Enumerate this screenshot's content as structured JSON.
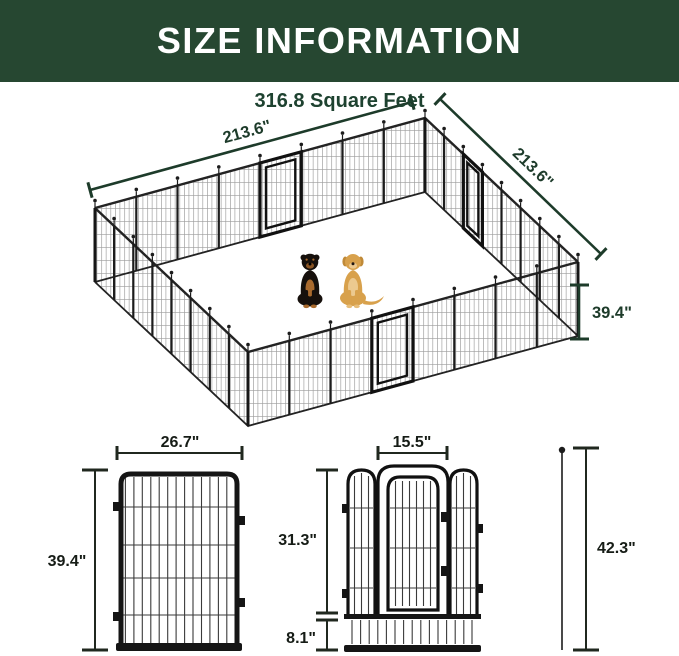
{
  "header": {
    "title": "SIZE INFORMATION"
  },
  "overview": {
    "area_label": "316.8 Square Feet",
    "width_label": "213.6\"",
    "depth_label": "213.6\"",
    "height_label": "39.4\"",
    "dogs": [
      "rottweiler",
      "golden-retriever"
    ]
  },
  "panel_detail": {
    "width_label": "26.7\"",
    "height_label": "39.4\""
  },
  "gate_detail": {
    "door_width_label": "15.5\"",
    "upper_height_label": "31.3\"",
    "bottom_height_label": "8.1\"",
    "total_height_label": "42.3\""
  },
  "colors": {
    "header_bg": "#264731",
    "accent_green": "#1d3b2a",
    "dim_dark": "#20281f",
    "metal_black": "#151515"
  }
}
